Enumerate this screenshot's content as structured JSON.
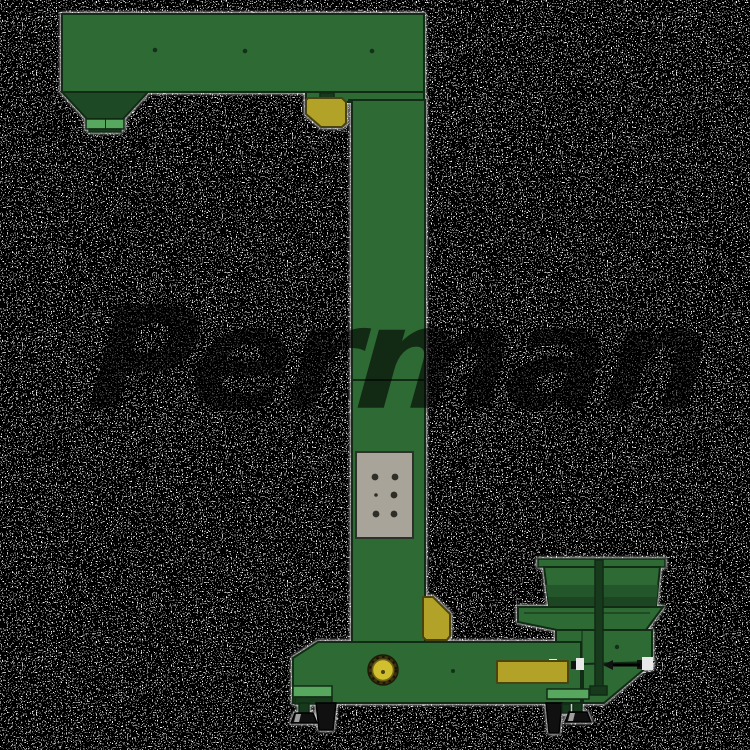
{
  "scene": {
    "description": "Z-type bucket elevator product render on speckled background",
    "background": {
      "style": "black-white-speckle-noise",
      "base_color": "#000000",
      "speckle_color": "#ffffff"
    }
  },
  "watermark": {
    "text": "Perman",
    "color": "rgba(0,0,0,0.60)"
  },
  "machine": {
    "colors": {
      "body_green": "#2e6a34",
      "hopper_dark_green": "#1d4a24",
      "accent_light_green": "#58a75f",
      "accent_yellow": "#b2a328",
      "motor_yellow": "#d2bf2e",
      "panel_gray": "#a8a49a",
      "outline": "#112b15",
      "wheel_black": "#101010"
    },
    "parts": [
      "top-discharge-arm",
      "discharge-hopper",
      "corner-bearing-cover",
      "elevator-column",
      "access-panel",
      "column-bracket",
      "machine-base",
      "drive-motor",
      "name-plate",
      "feed-hopper",
      "vibratory-feeder",
      "discharge-chute",
      "support-rod",
      "caster-wheels",
      "leveling-feet"
    ]
  }
}
